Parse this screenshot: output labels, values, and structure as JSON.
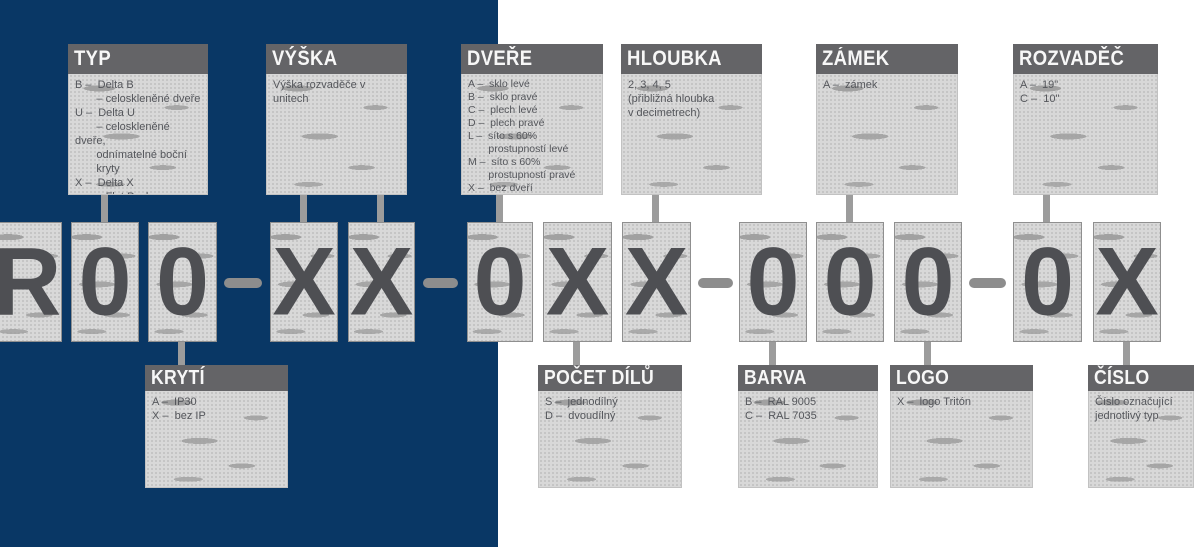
{
  "code": {
    "full_string": "R00-XX-0XX-000-0X",
    "chars": [
      {
        "char": "R"
      },
      {
        "char": "0"
      },
      {
        "char": "0"
      },
      {
        "char": "X"
      },
      {
        "char": "X"
      },
      {
        "char": "0"
      },
      {
        "char": "X"
      },
      {
        "char": "X"
      },
      {
        "char": "0"
      },
      {
        "char": "0"
      },
      {
        "char": "0"
      },
      {
        "char": "0"
      },
      {
        "char": "X"
      }
    ]
  },
  "legend_top": [
    {
      "title": "TYP",
      "body": "B –  Delta B\n       – celoskleněné dveře\nU –  Delta U\n       – celoskleněné dveře,\n       odnímatelné boční\n       kryty\nX –  Delta X\n       – Flat Pack"
    },
    {
      "title": "VÝŠKA",
      "body": "Výška rozvaděče v unitech"
    },
    {
      "title": "DVEŘE",
      "body": "A –  sklo levé\nB –  sklo pravé\nC –  plech levé\nD –  plech pravé\nL –  síto s 60%\n       prostupností levé\nM –  síto s 60%\n       prostupností pravé\nX –  bez dveří"
    },
    {
      "title": "HLOUBKA",
      "body": "2, 3, 4, 5\n(přibližná hloubka\nv decimetrech)"
    },
    {
      "title": "ZÁMEK",
      "body": "A –  zámek"
    },
    {
      "title": "ROZVADĚČ",
      "body": "A –  19\"\nC –  10\""
    }
  ],
  "legend_bottom": [
    {
      "title": "KRYTÍ",
      "body": "A –  IP30\nX –  bez IP"
    },
    {
      "title": "POČET DÍLŮ",
      "body": "S –  jednodílný\nD –  dvoudílný"
    },
    {
      "title": "BARVA",
      "body": "B –  RAL 9005\nC –  RAL 7035"
    },
    {
      "title": "LOGO",
      "body": "X –  logo Tritón"
    },
    {
      "title": "ČÍSLO",
      "body": "Číslo označující\njednotlivý typ"
    }
  ],
  "colors": {
    "background_left": "#093765",
    "background_right": "#ffffff",
    "legend_header": "#646467",
    "panel_gray": "#d8d8d8",
    "body_text": "#54565b",
    "glyph": "#4e4f53",
    "connector": "#9c9c9c"
  }
}
